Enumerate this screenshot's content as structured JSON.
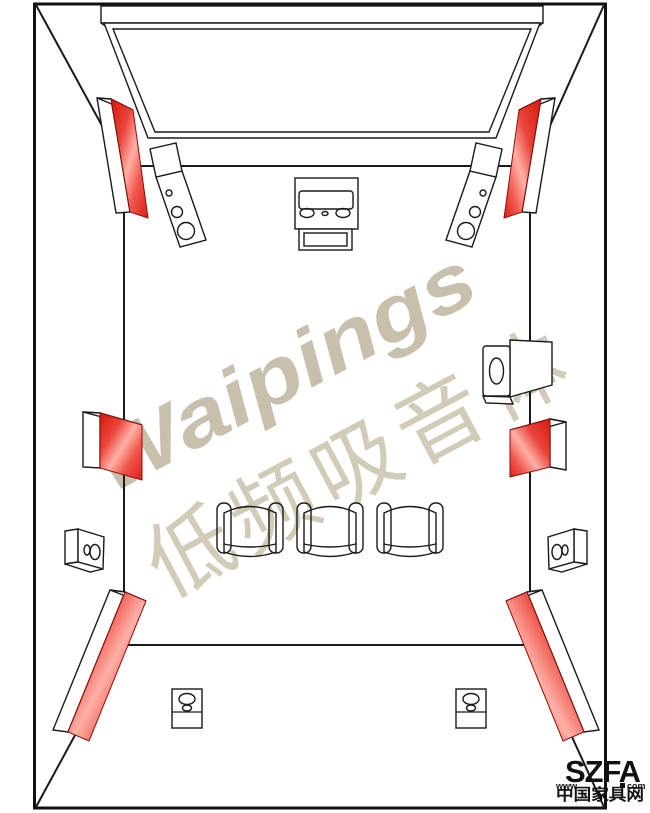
{
  "canvas": {
    "width": 650,
    "height": 813,
    "background": "#ffffff"
  },
  "colors": {
    "line": "#1a1a1a",
    "border": "#111111",
    "panel_red_dark": "#d8180f",
    "panel_red_mid": "#ea453b",
    "panel_red_highlight": "#ffb0a6",
    "watermark_brand": "#c8c0ac",
    "watermark_caption": "#d2cbb8",
    "logo_text": "#111111"
  },
  "watermarks": {
    "brand": "Waipings",
    "caption": "低频吸音体"
  },
  "logo": {
    "prefix": "www",
    "brand": "SZFA",
    "suffix": "com",
    "site_name": "中国家具网"
  },
  "diagram": {
    "type": "home-theater-room-acoustic-layout",
    "view": "splayed top-down perspective",
    "elements": [
      "room-border",
      "corner-seam-lines",
      "floor-outline",
      "projection-screen",
      "front-left-speaker",
      "front-right-speaker",
      "center-equipment-rack",
      "bass-absorber-panel-front-left",
      "bass-absorber-panel-front-right",
      "bass-absorber-panel-mid-left",
      "bass-absorber-panel-mid-right",
      "bass-absorber-panel-rear-left",
      "bass-absorber-panel-rear-right",
      "side-surround-speaker-right",
      "wall-speaker-left",
      "wall-speaker-right",
      "recliner-seat-1",
      "recliner-seat-2",
      "recliner-seat-3",
      "rear-floor-speaker-left",
      "rear-floor-speaker-right"
    ]
  }
}
